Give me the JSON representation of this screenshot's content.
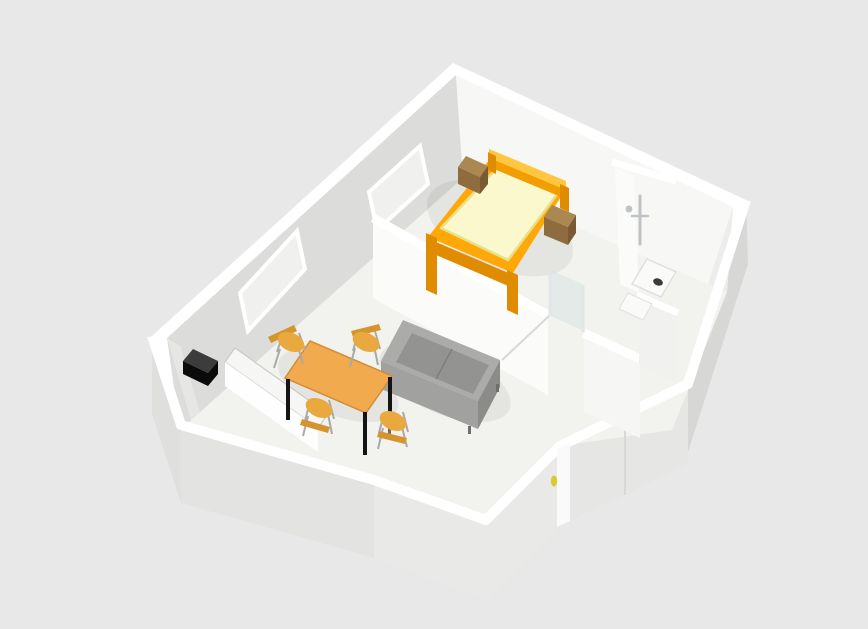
{
  "scene": {
    "title": "apartment-3d-floorplan-render",
    "description": "Perspective bird's-eye 3D rendering of a one-bedroom apartment: bedroom with double bed and two nightstands, living-dining area with grey sofa, wooden dining table and four chairs, kitchen corner with white counter and black appliance, bathroom with shower fixture, shower tray and washbasin, entrance door with yellow handle",
    "view": "perspective-birds-eye",
    "background": "#E8E8E8"
  },
  "rooms": [
    {
      "name": "bedroom",
      "contents": [
        "double-bed",
        "nightstand-left",
        "nightstand-right",
        "window-bedroom"
      ]
    },
    {
      "name": "living-dining-room",
      "contents": [
        "sofa",
        "dining-table",
        "chair-north",
        "chair-east",
        "chair-west",
        "chair-south",
        "window-living"
      ]
    },
    {
      "name": "kitchen-corner",
      "contents": [
        "kitchen-counter",
        "black-appliance"
      ]
    },
    {
      "name": "bathroom",
      "contents": [
        "shower-fixture",
        "shower-tray",
        "washbasin",
        "glass-screen"
      ]
    },
    {
      "name": "entrance",
      "contents": [
        "entry-door"
      ]
    }
  ],
  "palette": {
    "background": "#E8E8E8",
    "wallTop": "#FFFFFF",
    "wallBackLeft": "#DCDCDA",
    "wallBackRight": "#F7F7F5",
    "wallRightInner": "#EDEDEB",
    "wallLeftInner": "#E6E6E4",
    "extRight": "#D7D7D5",
    "extDoorWall": "#E6E6E4",
    "extFrontLower": "#E9E9E7",
    "extChamfer": "#E3E3E1",
    "extLeftLower": "#DFDFDD",
    "floor": "#F2F2EF",
    "partitionFace": "#FBFBF9",
    "partitionFace2": "#F6F6F4",
    "bathWallFace": "#F1F1EF",
    "windowPane": "#F0F0EE",
    "windowFrame": "#FFFFFF",
    "glass": "rgba(213,226,226,0.5)",
    "glassFrame": "#E2E6E6",
    "showerMetal": "#BFC3C5",
    "trayFill": "#FAFAF8",
    "trayEdge": "#E0E0DE",
    "drain": "#3A3A3A",
    "doorStrip": "#FAFAFA",
    "doorSeam": "#D8D8D6",
    "doorHandle": "#D6CC32",
    "bedFrame": "#FFA807",
    "bedFrameDark": "#E08C00",
    "bedFrameLight": "#FFC63F",
    "bedFrameFace": "#F09E00",
    "mattress": "#FCF8CE",
    "mattressEdge": "#E9E08A",
    "nightstandTop": "#AB8752",
    "nightstandFront": "#8F6C3F",
    "nightstandSide": "#7A5A34",
    "sofaTop": "#ABABA9",
    "sofaSeat": "#939391",
    "sofaFront": "#A1A19F",
    "sofaSide": "#8B8B89",
    "sofaSeam": "#7E7E7C",
    "sofaLeg": "#6E6E6E",
    "tableTop": "#F1AA4E",
    "tableEdge": "#D18E33",
    "tableLeg": "#141414",
    "chairSeat": "#E9A93E",
    "chairBack": "#D6942F",
    "chairLeg": "#A9A9A7",
    "counterTop": "#F6F6F4",
    "counterFront": "#FEFEFE",
    "counterEdge": "#C4C4C2",
    "applianceTop": "#3C3C3C",
    "applianceFront": "#0B0B0B",
    "shadow": "rgba(0,0,0,0.055)"
  }
}
